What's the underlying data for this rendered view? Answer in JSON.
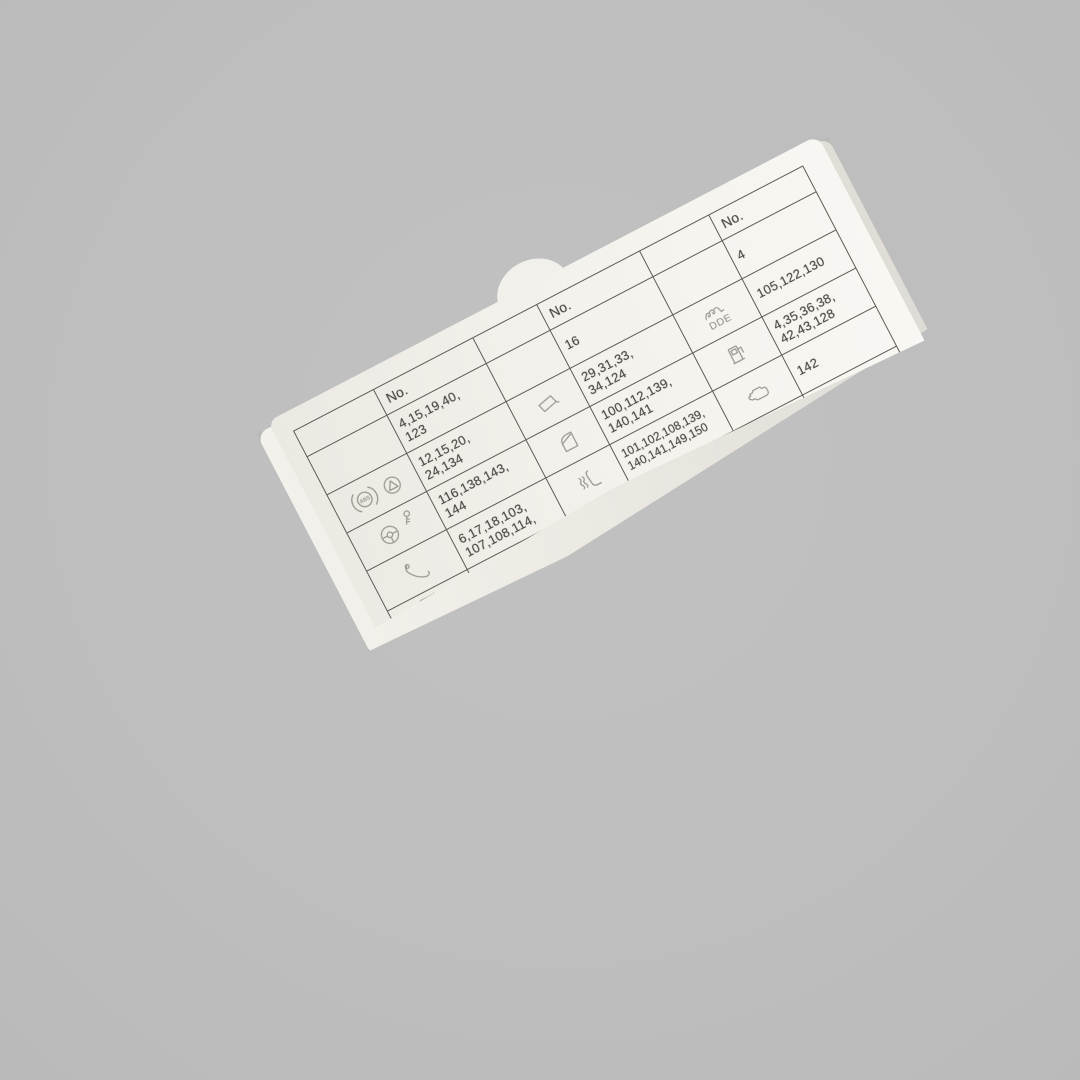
{
  "photo": {
    "background_color": "#bebebe",
    "card_color": "#f3f1eb",
    "grid_line_color": "#5c5b56",
    "number_text_color": "#454440",
    "icon_color": "#9a9892"
  },
  "table": {
    "header_label": "No.",
    "sections": [
      {
        "id": "left",
        "rows": [
          {
            "icons": [],
            "numbers": "4,15,19,40,\n123"
          },
          {
            "icons": [
              "abs-icon",
              "traction-triangle-icon"
            ],
            "abs_label": "ABS",
            "numbers": "12,15,20,\n24,134"
          },
          {
            "icons": [
              "steering-wheel-icon",
              "key-icon"
            ],
            "numbers": "116,138,143,\n144"
          },
          {
            "icons": [
              "phone-handset-icon"
            ],
            "numbers": "6,17,18,103,\n107,108,114,"
          },
          {
            "icons": [
              "cigarette-lighter-icon"
            ],
            "numbers": ""
          }
        ]
      },
      {
        "id": "middle",
        "rows": [
          {
            "icons": [],
            "numbers": "16"
          },
          {
            "icons": [
              "mirror-icon"
            ],
            "numbers": "29,31,33,\n34,124"
          },
          {
            "icons": [
              "door-icon"
            ],
            "numbers": "100,112,139,\n140,141"
          },
          {
            "icons": [
              "heated-seat-icon"
            ],
            "numbers": "101,102,108,139,\n140,141,149,150"
          },
          {
            "icons": [
              "seat-icon"
            ],
            "numbers": ""
          }
        ]
      },
      {
        "id": "right",
        "rows": [
          {
            "icons": [],
            "numbers": "4"
          },
          {
            "icons": [
              "glow-plug-icon"
            ],
            "caption": "DDE",
            "numbers": "105,122,130"
          },
          {
            "icons": [
              "fuel-pump-icon"
            ],
            "numbers": "4,35,36,38,\n42,43,128"
          },
          {
            "icons": [
              "engine-icon"
            ],
            "numbers": "142"
          },
          {
            "icons": [
              "antenna-icon"
            ],
            "caption_left": "N",
            "caption_right": "JAP",
            "numbers": ""
          }
        ]
      }
    ]
  }
}
